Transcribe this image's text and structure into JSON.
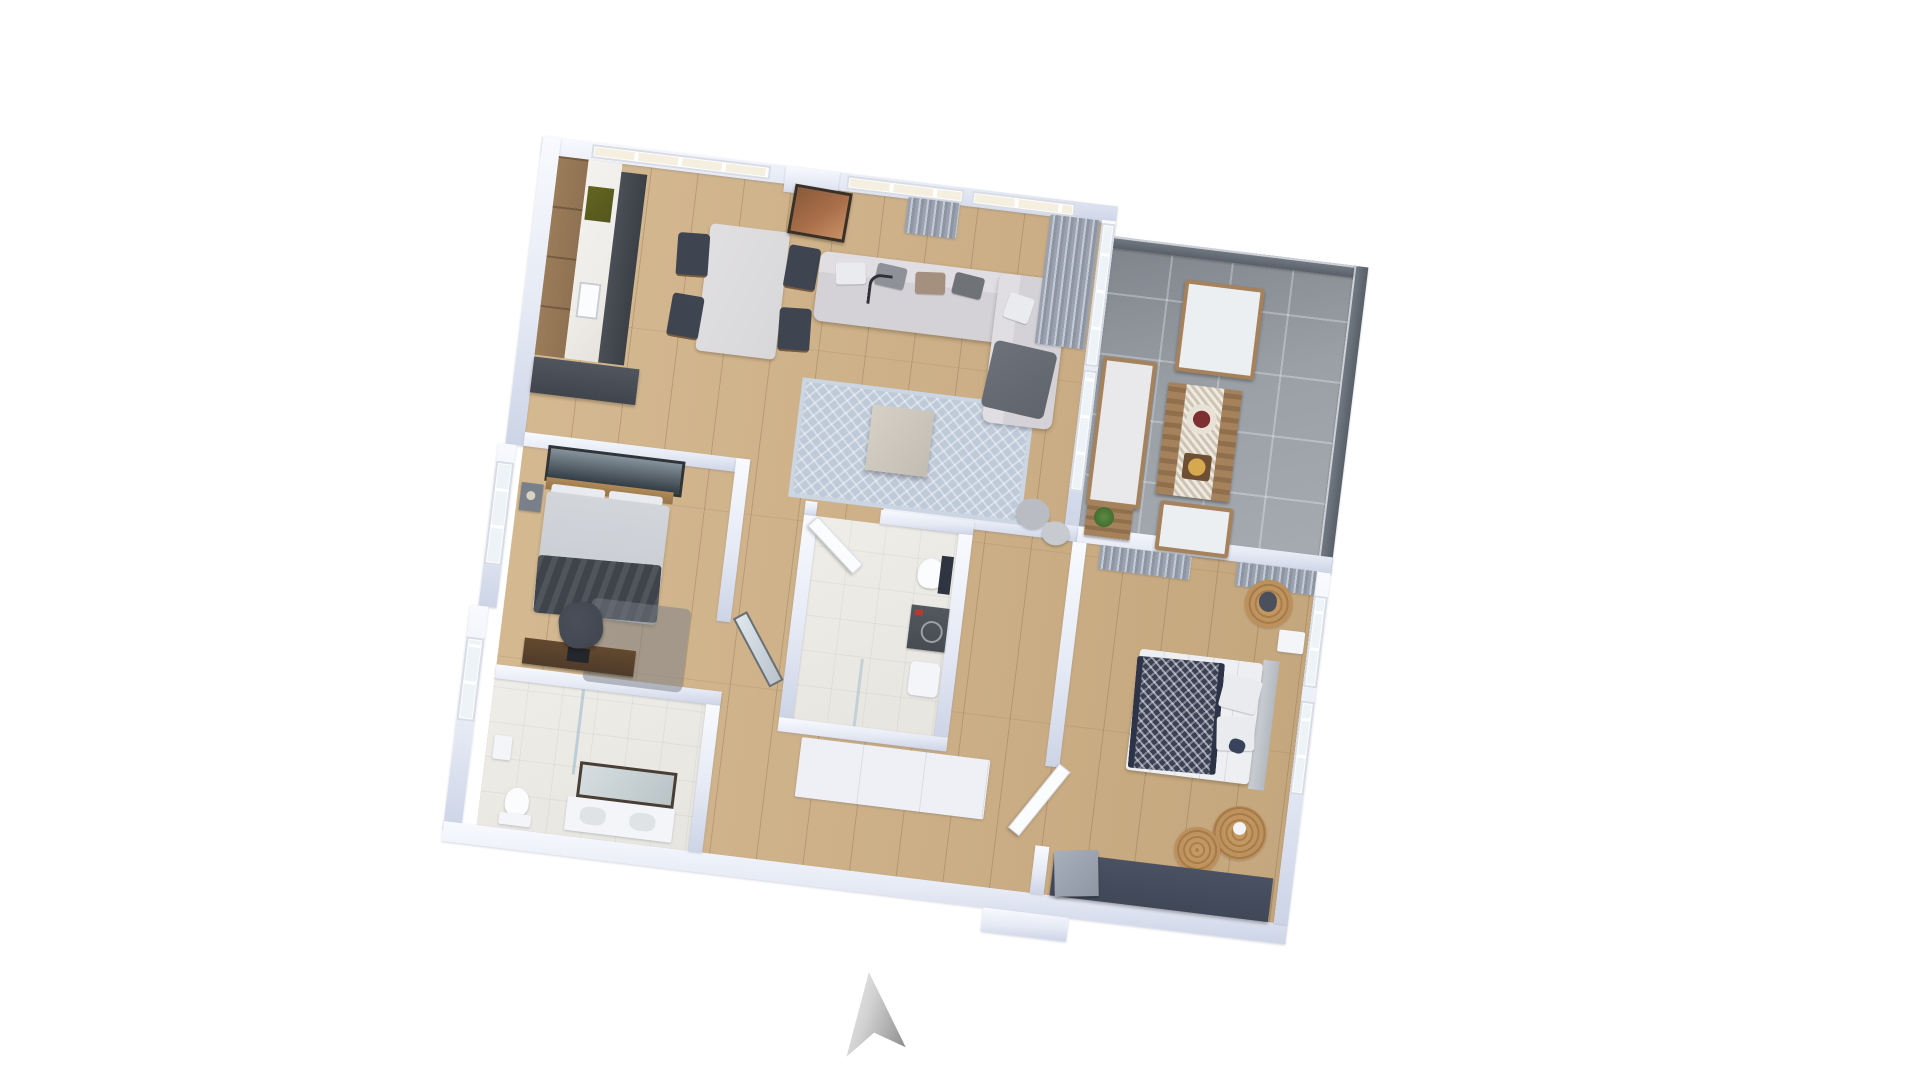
{
  "scene": {
    "type": "3d-floorplan-render",
    "background": "#ffffff",
    "floors": {
      "interior": "light-oak-wood",
      "balcony": "gray-tile",
      "bathrooms": "light-tile"
    }
  },
  "compass": {
    "name": "north-arrow",
    "direction": "up"
  },
  "palette": {
    "wall": "#e6eaf5",
    "wall-top": "#f8fafe",
    "wall-shade": "#ccd4e6",
    "wood-floor": "#cfb084",
    "balcony-tile": "#9aa0a6",
    "bath-tile": "#e7e5e0",
    "glass-pale": "#eef3f8",
    "glass-cream": "#f5efdf",
    "frame-white": "#fdfdfe",
    "railing-glass": "#4a525c",
    "cabinet-dark": "#3b4046",
    "wood-furn": "#8f7252",
    "marble": "#efede9",
    "cooktop": "#54561e",
    "sofa": "#d4d2d6",
    "throw": "#5f646c",
    "rug-living": "#bfcad9",
    "table-top": "#d8d7d9",
    "chair-dark": "#3e4550",
    "copper": "#a96f4a",
    "bed-sheet": "#c6c9cf",
    "blanket-dark": "#3f434b",
    "bed2-white": "#edeff2",
    "navy": "#3a4154",
    "jute": "#b68a57",
    "curtain": "#9aa2af",
    "washer": "#474b52",
    "accent-red": "#b23a32",
    "desk-wood": "#4f3b2a",
    "office-chair": "#3f444d",
    "wardrobe-navy": "#404757",
    "compass-light": "#f2f2f2",
    "compass-dark": "#8b8b8b"
  },
  "rooms": [
    {
      "name": "kitchen-dining",
      "furniture": [
        "tall-wood-cabinets",
        "marble-counter",
        "sink",
        "cooktop",
        "dark-base-cabinets",
        "kitchen-island",
        "dining-table",
        "dining-chair",
        "copper-artwork"
      ]
    },
    {
      "name": "living-room",
      "furniture": [
        "sofa-with-chaise",
        "scatter-cushions",
        "dark-throw",
        "arc-floor-lamp",
        "patterned-area-rug",
        "coffee-table",
        "curtains",
        "poufs"
      ]
    },
    {
      "name": "balcony",
      "furniture": [
        "outdoor-sofa",
        "outdoor-daybed",
        "outdoor-coffee-table",
        "serving-trays",
        "outdoor-armchair",
        "side-table",
        "potted-plant",
        "tinted-glass-railing"
      ]
    },
    {
      "name": "master-bedroom",
      "furniture": [
        "double-bed",
        "dark-bedding",
        "headboard",
        "wall-artwork",
        "nightstand",
        "table-lamp",
        "desk",
        "office-chair",
        "gray-rug"
      ]
    },
    {
      "name": "bathroom-1",
      "furniture": [
        "shower-area",
        "glass-screen",
        "toilet",
        "double-vanity",
        "framed-mirror",
        "wall-panel"
      ]
    },
    {
      "name": "bathroom-2",
      "furniture": [
        "door-leaf",
        "toilet",
        "washing-machine",
        "basin",
        "shower-screen"
      ]
    },
    {
      "name": "hallway",
      "furniture": [
        "white-storage-cabinets",
        "entry-stub"
      ]
    },
    {
      "name": "bedroom-2",
      "furniture": [
        "double-bed",
        "navy-checked-throw",
        "headboard",
        "nightstand",
        "jute-rug",
        "navy-wardrobe",
        "curtains",
        "door-leaf"
      ]
    }
  ]
}
